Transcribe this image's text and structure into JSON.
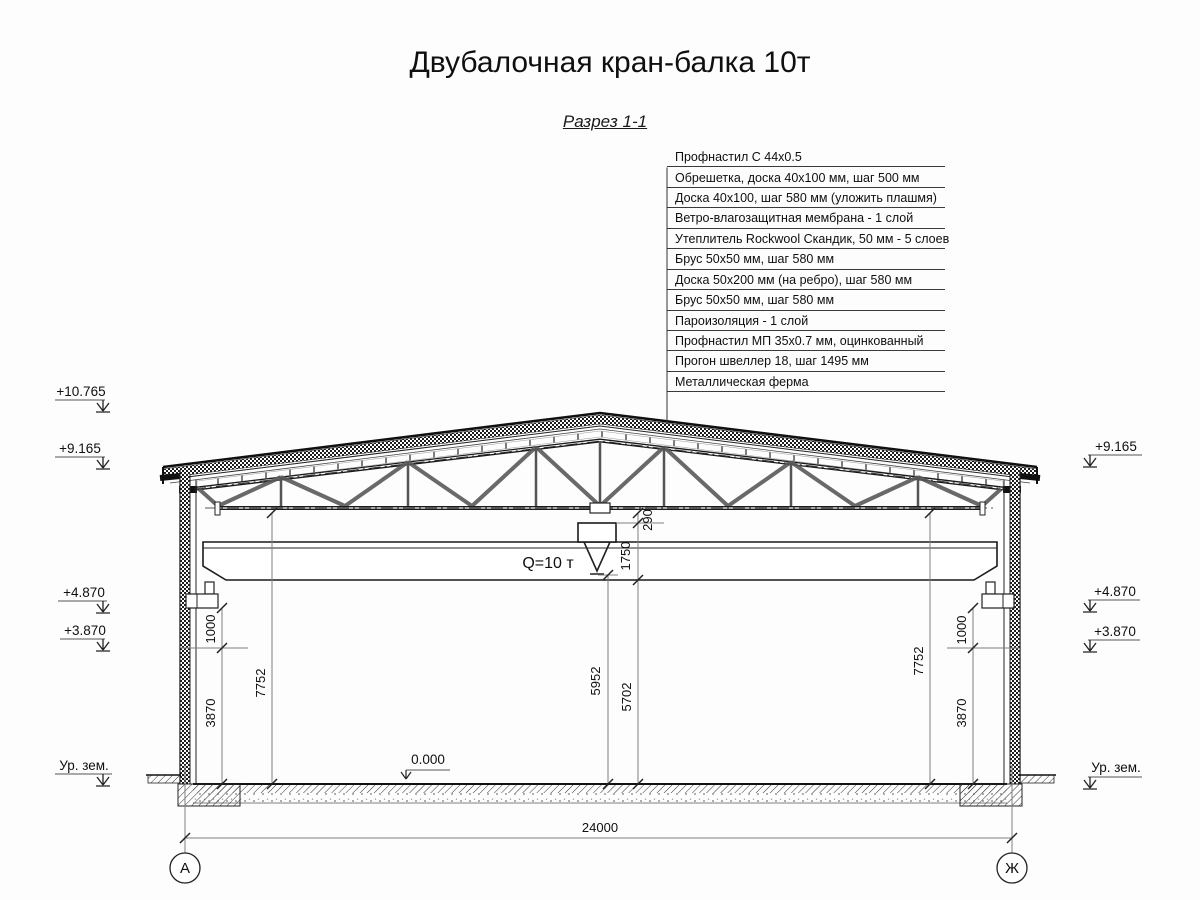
{
  "title": "Двубалочная кран-балка 10т",
  "subtitle": "Разрез 1-1",
  "roof_layers": [
    "Профнастил С 44х0.5",
    "Обрешетка, доска 40х100 мм, шаг 500 мм",
    "Доска 40х100, шаг 580 мм (уложить плашмя)",
    "Ветро-влагозащитная мембрана - 1 слой",
    "Утеплитель Rockwool Скандик, 50 мм - 5 слоев",
    "Брус 50х50 мм, шаг 580 мм",
    "Доска 50х200 мм (на ребро), шаг 580 мм",
    "Брус 50х50 мм, шаг 580 мм",
    "Пароизоляция - 1 слой",
    "Профнастил МП 35х0.7 мм, оцинкованный",
    "Прогон швеллер 18, шаг 1495 мм",
    "Металлическая ферма"
  ],
  "crane": {
    "capacity": "Q=10 т"
  },
  "elevations": {
    "ridge": "+10.765",
    "eave_left": "+9.165",
    "eave_right": "+9.165",
    "rail_left": "+4.870",
    "rail_right": "+4.870",
    "level_left": "+3.870",
    "level_right": "+3.870",
    "ground_left": "Ур. зем.",
    "ground_right": "Ур. зем.",
    "floor": "0.000"
  },
  "dimensions": {
    "span": "24000",
    "clear_height_left": "7752",
    "clear_height_right": "7752",
    "rail_gap_left": "1000",
    "rail_gap_right": "1000",
    "rail_height_left": "3870",
    "rail_height_right": "3870",
    "hook_clearance": "5952",
    "beam_clearance": "5702",
    "trolley_height": "1750",
    "chord_offset": "290"
  },
  "axes": {
    "left": "А",
    "right": "Ж"
  }
}
